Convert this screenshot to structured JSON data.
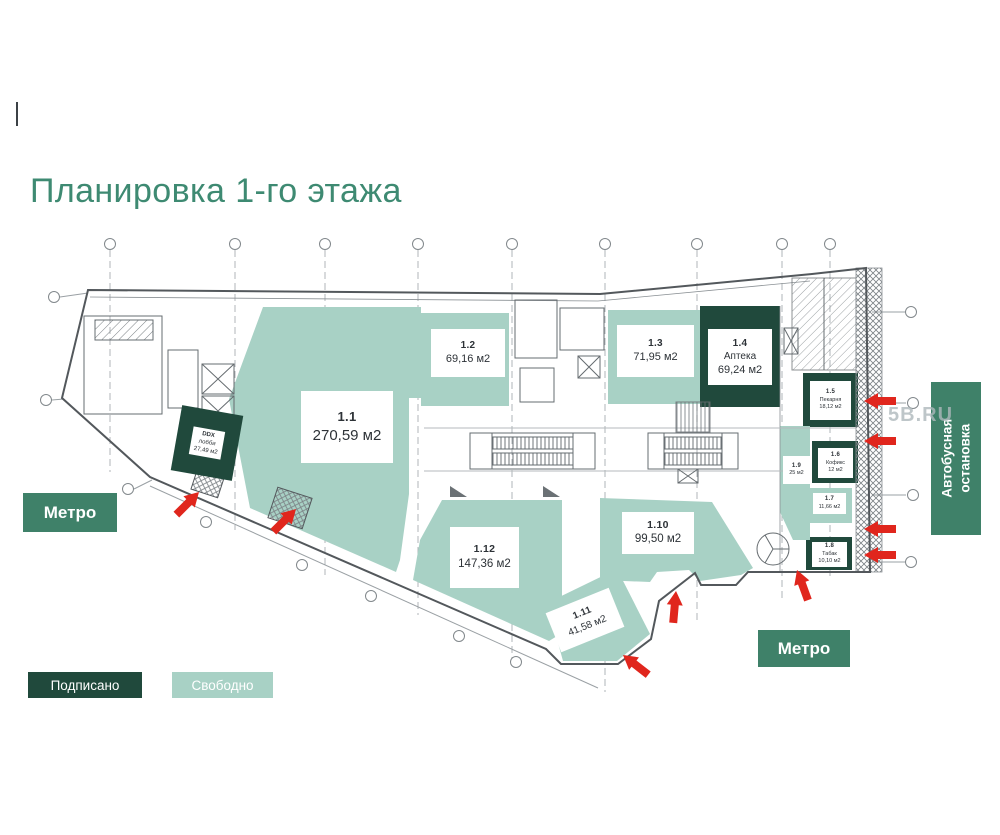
{
  "title": "Планировка 1-го этажа",
  "colors": {
    "free": "#A8D1C5",
    "signed": "#20493C",
    "label_green": "#3F8169",
    "arrow_red": "#E0261D",
    "title": "#3E8A72"
  },
  "legend": {
    "items": [
      {
        "label": "Подписано",
        "status": "signed"
      },
      {
        "label": "Свободно",
        "status": "free"
      }
    ]
  },
  "labels": {
    "metro_left": "Метро",
    "metro_right": "Метро",
    "bus_stop": "Автобусная остановка",
    "watermark": "5B.RU"
  },
  "units": [
    {
      "number": "1.1",
      "area": "270,59 м2",
      "status": "free"
    },
    {
      "number": "1.2",
      "area": "69,16 м2",
      "status": "free"
    },
    {
      "number": "1.3",
      "area": "71,95 м2",
      "status": "free"
    },
    {
      "number": "1.4",
      "tenant": "Аптека",
      "area": "69,24 м2",
      "status": "signed"
    },
    {
      "number": "1.5",
      "tenant": "Пекарня",
      "area": "18,12 м2",
      "status": "signed"
    },
    {
      "number": "1.6",
      "tenant": "Кофикс",
      "area": "12 м2",
      "status": "signed"
    },
    {
      "number": "1.7",
      "area": "11,66 м2",
      "status": "free"
    },
    {
      "number": "1.8",
      "tenant": "Табак",
      "area": "10,10 м2",
      "status": "signed"
    },
    {
      "number": "1.9",
      "area": "25 м2",
      "status": "free"
    },
    {
      "number": "1.10",
      "area": "99,50 м2",
      "status": "free"
    },
    {
      "number": "1.11",
      "area": "41,58 м2",
      "status": "free"
    },
    {
      "number": "1.12",
      "area": "147,36 м2",
      "status": "free"
    },
    {
      "number": "DDX",
      "tenant": "лобби",
      "area": "27,49 м2",
      "status": "signed"
    }
  ]
}
